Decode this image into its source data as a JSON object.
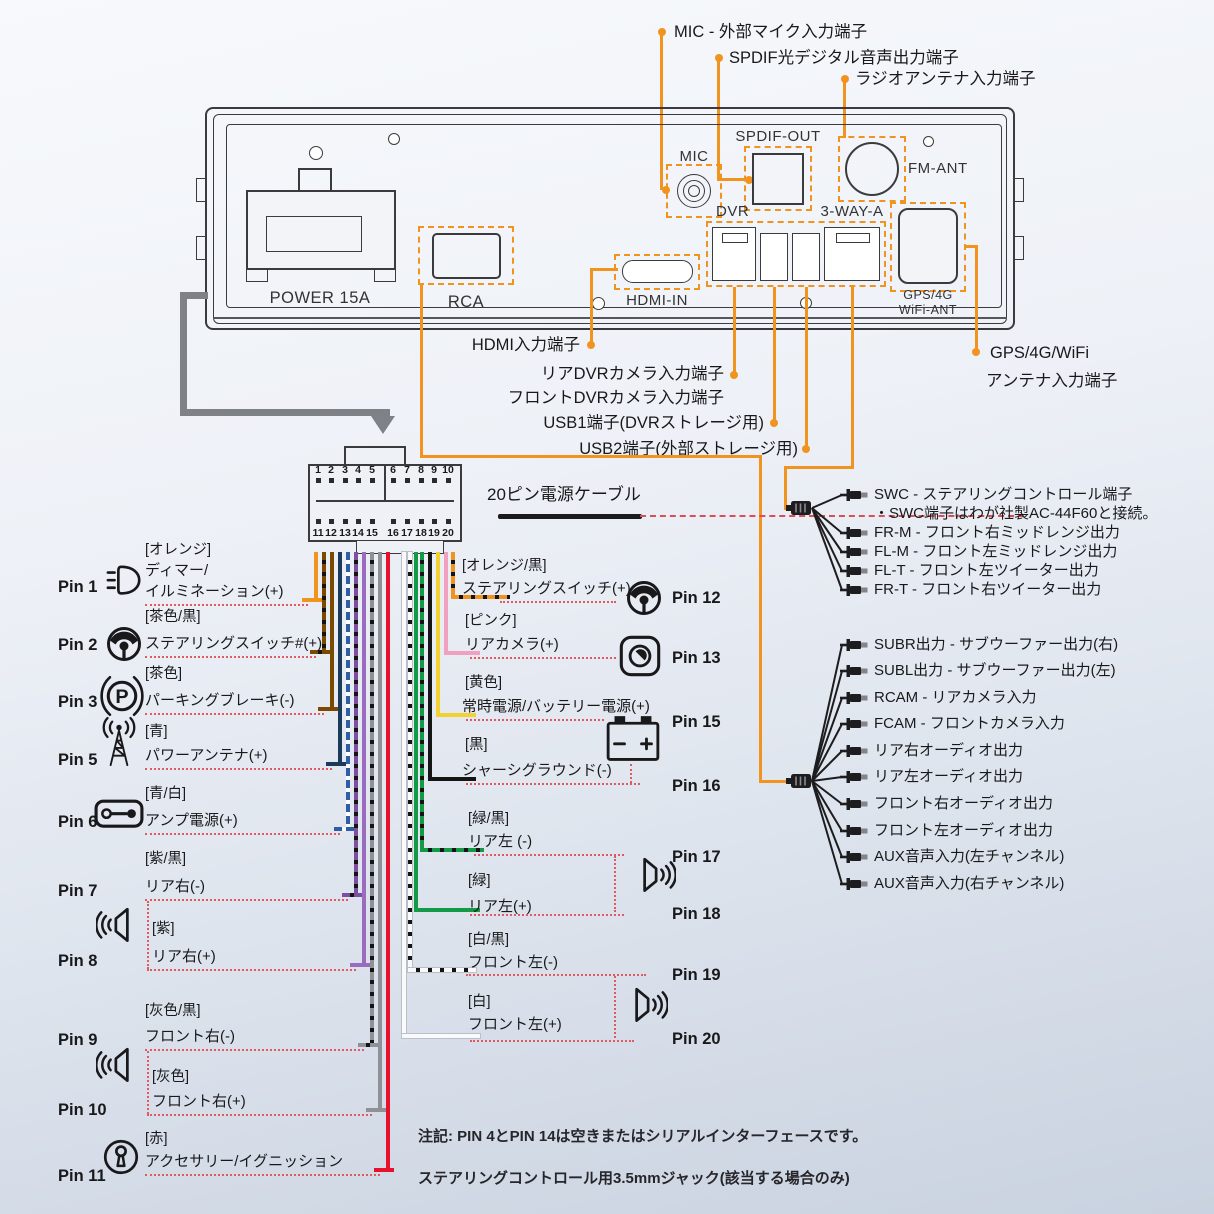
{
  "top_labels": {
    "mic": "MIC - 外部マイク入力端子",
    "spdif": "SPDIF光デジタル音声出力端子",
    "radio": "ラジオアンテナ入力端子"
  },
  "unit": {
    "power": "POWER 15A",
    "rca": "RCA",
    "mic": "MIC",
    "spdif_out": "SPDIF-OUT",
    "fm_ant": "FM-ANT",
    "dvr": "DVR",
    "three_way": "3-WAY-A",
    "hdmi_in": "HDMI-IN",
    "gps_line1": "GPS/4G",
    "gps_line2": "WiFi-ANT"
  },
  "port_labels": {
    "hdmi": "HDMI入力端子",
    "dvr_rear": "リアDVRカメラ入力端子",
    "dvr_front": "フロントDVRカメラ入力端子",
    "usb1": "USB1端子(DVRストレージ用)",
    "usb2": "USB2端子(外部ストレージ用)",
    "gps1": "GPS/4G/WiFi",
    "gps2": "アンテナ入力端子"
  },
  "connector": {
    "label": "20ピン電源ケーブル",
    "pins_top": [
      "1",
      "2",
      "3",
      "4",
      "5",
      "6",
      "7",
      "8",
      "9",
      "10"
    ],
    "pins_bottom": [
      "11",
      "12",
      "13",
      "14",
      "15",
      "16",
      "17",
      "18",
      "19",
      "20"
    ]
  },
  "accent_colors": {
    "orange": "#F0941F",
    "red_dash": "#E05A62",
    "line_art": "#3b3b3d",
    "gray_cable": "#7e8287"
  },
  "pins_left": [
    {
      "label": "Pin 1",
      "color_label": "[オレンジ]",
      "name_lines": [
        "ディマー/",
        "イルミネーション(+)"
      ],
      "wire_color": "#F0941F",
      "icon": "headlight-icon"
    },
    {
      "label": "Pin 2",
      "color_label": "[茶色/黒]",
      "name_lines": [
        "ステアリングスイッチ#(+)"
      ],
      "wire_color": "#7A4A00",
      "wire_stripe": "#141414",
      "icon": "steering-wheel-icon"
    },
    {
      "label": "Pin 3",
      "color_label": "[茶色]",
      "name_lines": [
        "パーキングブレーキ(-)"
      ],
      "wire_color": "#7A4A00",
      "icon": "parking-brake-icon"
    },
    {
      "label": "Pin 5",
      "color_label": "[青]",
      "name_lines": [
        "パワーアンテナ(+)"
      ],
      "wire_color": "#1B3A5C",
      "icon": "antenna-icon"
    },
    {
      "label": "Pin 6",
      "color_label": "[青/白]",
      "name_lines": [
        "アンプ電源(+)"
      ],
      "wire_color": "#2E5FA5",
      "wire_stripe": "#FFFFFF",
      "icon": "amplifier-icon"
    },
    {
      "label": "Pin 7",
      "color_label": "[紫/黒]",
      "name_lines": [
        "リア右(-)"
      ],
      "wire_color": "#7D4FA0",
      "wire_stripe": "#141414",
      "icon": ""
    },
    {
      "label": "Pin 8",
      "color_label": "[紫]",
      "name_lines": [
        "リア右(+)"
      ],
      "wire_color": "#9B6BBF",
      "icon": "speaker-icon"
    },
    {
      "label": "Pin 9",
      "color_label": "[灰色/黒]",
      "name_lines": [
        "フロント右(-)"
      ],
      "wire_color": "#8E9296",
      "wire_stripe": "#141414",
      "icon": ""
    },
    {
      "label": "Pin 10",
      "color_label": "[灰色]",
      "name_lines": [
        "フロント右(+)"
      ],
      "wire_color": "#8E9296",
      "icon": "speaker-icon"
    },
    {
      "label": "Pin 11",
      "color_label": "[赤]",
      "name_lines": [
        "アクセサリー/イグニッション"
      ],
      "wire_color": "#E8112D",
      "icon": "ignition-key-icon"
    }
  ],
  "pins_right": [
    {
      "label": "Pin 12",
      "color_label": "[オレンジ/黒]",
      "name_lines": [
        "ステアリングスイッチ(+)"
      ],
      "wire_color": "#F0941F",
      "wire_stripe": "#141414",
      "icon": "steering-wheel-icon"
    },
    {
      "label": "Pin 13",
      "color_label": "[ピンク]",
      "name_lines": [
        "リアカメラ(+)"
      ],
      "wire_color": "#F2A0C0",
      "icon": "camera-icon"
    },
    {
      "label": "Pin 15",
      "color_label": "[黄色]",
      "name_lines": [
        "常時電源/バッテリー電源(+)"
      ],
      "wire_color": "#F2D230",
      "icon": "battery-icon"
    },
    {
      "label": "Pin 16",
      "color_label": "[黒]",
      "name_lines": [
        "シャーシグラウンド(-)"
      ],
      "wire_color": "#151515",
      "icon": ""
    },
    {
      "label": "Pin 17",
      "color_label": "[緑/黒]",
      "name_lines": [
        "リア左 (-)"
      ],
      "wire_color": "#149A47",
      "wire_stripe": "#141414",
      "icon": ""
    },
    {
      "label": "Pin 18",
      "color_label": "[緑]",
      "name_lines": [
        "リア左(+)"
      ],
      "wire_color": "#149A47",
      "icon": "speaker-icon"
    },
    {
      "label": "Pin 19",
      "color_label": "[白/黒]",
      "name_lines": [
        "フロント左(-)"
      ],
      "wire_color": "#FAFAFA",
      "wire_stripe": "#141414",
      "icon": ""
    },
    {
      "label": "Pin 20",
      "color_label": "[白]",
      "name_lines": [
        "フロント左(+)"
      ],
      "wire_color": "#FAFAFA",
      "icon": "speaker-icon"
    }
  ],
  "swc_group": {
    "items": [
      "SWC - ステアリングコントロール端子",
      "FR-M - フロント右ミッドレンジ出力",
      "FL-M - フロント左ミッドレンジ出力",
      "FL-T - フロント左ツイーター出力",
      "FR-T - フロント右ツイーター出力"
    ],
    "note": "・SWC端子はわが社製AC-44F60と接続。"
  },
  "rca_group": {
    "items": [
      "SUBR出力 - サブウーファー出力(右)",
      "SUBL出力 - サブウーファー出力(左)",
      "RCAM - リアカメラ入力",
      "FCAM - フロントカメラ入力",
      "リア右オーディオ出力",
      "リア左オーディオ出力",
      "フロント右オーディオ出力",
      "フロント左オーディオ出力",
      "AUX音声入力(左チャンネル)",
      "AUX音声入力(右チャンネル)"
    ]
  },
  "notes": [
    "注記: PIN 4とPIN 14は空きまたはシリアルインターフェースです。",
    "ステアリングコントロール用3.5mmジャック(該当する場合のみ)"
  ]
}
